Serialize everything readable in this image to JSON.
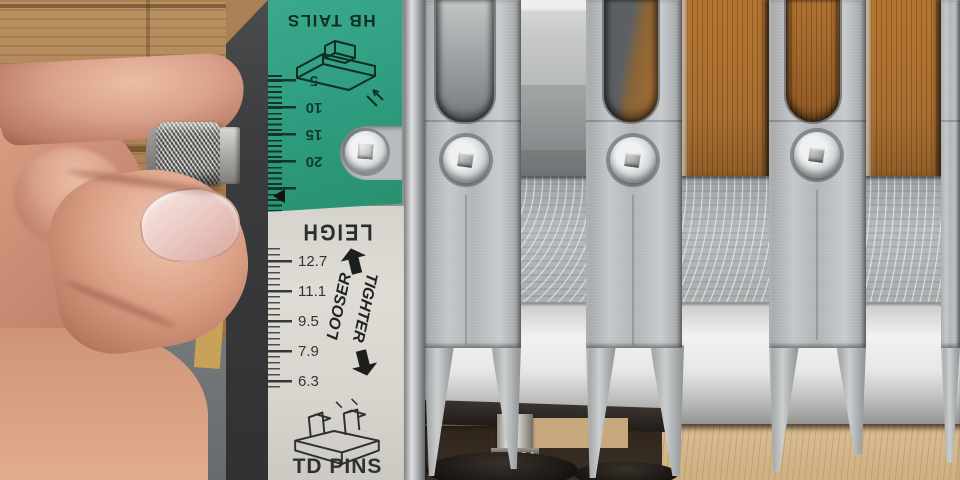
{
  "scene": {
    "alt": "Close-up photo of a hand turning the knurled adjustment knob of a Leigh dovetail jig; teal and gray scale labels sit beside aluminum guide fingers clamped over wood boards."
  },
  "labels": {
    "hb_tails": {
      "title": "HB TAILS",
      "scale": [
        "5",
        "10",
        "15",
        "20"
      ]
    },
    "brand": "LEIGH",
    "td_pins": {
      "title": "TD PINS",
      "scale": [
        "12.7",
        "11.1",
        "9.5",
        "7.9",
        "6.3"
      ],
      "tighter": "TIGHTER",
      "looser": "LOOSER"
    }
  },
  "icons": {
    "tighter_arrow": "up-arrow",
    "looser_arrow": "down-arrow",
    "index_pointer": "left-triangle",
    "hb_tails_diagram": "half-blind-tail-board-line-drawing",
    "td_pins_diagram": "through-dovetail-pin-board-line-drawing"
  },
  "colors": {
    "label_green": "#2f9e81",
    "label_gray": "#d8d5cf",
    "aluminum": "#b9bcbe",
    "wood_back": "#a96e31",
    "wood_front": "#d9bd93",
    "bench_gray": "#75787b",
    "skin": "#d9a18b"
  }
}
